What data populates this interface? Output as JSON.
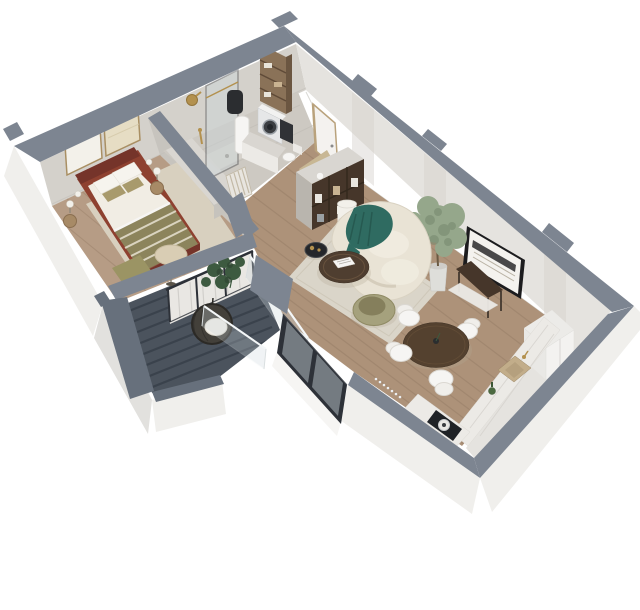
{
  "scene": {
    "type": "isometric-floor-plan-render",
    "description": "3D isometric cutaway render of a one-bedroom apartment viewed from above: bedroom top-left, bathroom top-center, entry hall, open living/dining room with curved cream sofa, kitchen bottom-right, and a balcony with dark decking bottom-left. Cut wall tops are slate gray, exterior faces white.",
    "background": "#ffffff"
  },
  "palette": {
    "wall_top": "#7d8591",
    "wall_top_dark": "#67707c",
    "outer_face": "#f0efec",
    "outer_face_shade": "#e2e1de",
    "inner_wall_light": "#e5e3df",
    "inner_wall_mid": "#d4d1cb",
    "inner_wall_dark": "#c7c4be",
    "floor_wood": "#ad9279",
    "floor_wood_bedroom": "#b69c85",
    "plank_line": "#8f7660",
    "bath_floor": "#cdc9c2",
    "rug_living": "#dad5c9",
    "rug_bedroom": "#d8d0bf",
    "balcony_floor": "#4b535d",
    "balcony_stripe": "#39414b",
    "glass": "#ccd7dc",
    "window_frame": "#2d3138",
    "door_white": "#f4f2ef",
    "door_frame": "#b9a27c",
    "doormat": "#c8b794",
    "bed_frame": "#8e4130",
    "bed_frame_dark": "#75342a",
    "duvet": "#f1ede4",
    "pillow_white": "#f6f4ee",
    "pillow_olive": "#a89a6c",
    "blanket_olive": "#8c845c",
    "blanket_cream": "#e8e2d2",
    "bench_olive": "#9b9464",
    "wood_furniture": "#54412f",
    "wood_furniture_dark": "#46362a",
    "wood_light": "#8a7258",
    "sofa_cream": "#e9e3d5",
    "sofa_shade": "#cfc7b5",
    "throw_teal": "#2f6b61",
    "throw_teal_dark": "#24554d",
    "armchair_olive": "#a5a17d",
    "armchair_olive_dark": "#857f5c",
    "tree_foliage": "#95a78b",
    "tree_foliage_dark": "#76886d",
    "monstera": "#3d5a40",
    "monstera_dark": "#2f4632",
    "pot_white": "#dededa",
    "lamp_shade": "#f2f0ea",
    "lamp_shade_beige": "#d9cdb4",
    "gold": "#b3914f",
    "near_black": "#24262a",
    "white": "#f6f5f3",
    "marble": "#eceae6",
    "marble_vein": "#d5d2cd",
    "sink_beige": "#c2ad8a",
    "sink_beige_dark": "#b5a07e",
    "appliance": "#e6e7e8",
    "appliance_dark": "#3a3d41",
    "cabinet_light": "#d9d6d1",
    "cabinet_mid": "#c6c3bd",
    "curtain": "#e9e7e3",
    "curtain_fold": "#cfcdc9",
    "rattan": "#43403a",
    "rattan_dark": "#2c2a26",
    "shadow": "#b5ac99"
  },
  "rooms": [
    {
      "id": "bedroom",
      "label": "Bedroom",
      "furniture": [
        "double-bed",
        "striped-throw-blanket",
        "two-framed-artworks",
        "nightstands",
        "wall-lamps",
        "floor-lamp",
        "bench",
        "area-rug",
        "wardrobe-cabinet"
      ]
    },
    {
      "id": "bathroom",
      "label": "Bathroom",
      "furniture": [
        "walk-in-shower",
        "gold-shower-head",
        "glass-partition",
        "water-heater",
        "washing-machine",
        "storage-column",
        "bathroom-cabinet",
        "toilet",
        "towel-radiator"
      ]
    },
    {
      "id": "entry-hall",
      "label": "Entry hall",
      "furniture": [
        "entry-door",
        "doormat",
        "wall-mirror"
      ]
    },
    {
      "id": "living-room",
      "label": "Living room",
      "furniture": [
        "curved-sofa",
        "teal-throw",
        "round-coffee-table",
        "open-shelf-unit",
        "floor-lamp",
        "wire-side-table",
        "olive-armchair",
        "area-rug",
        "potted-olive-tree",
        "console-table",
        "framed-wall-art"
      ]
    },
    {
      "id": "dining-area",
      "label": "Dining area",
      "furniture": [
        "round-dining-table",
        "dining-chairs-x4"
      ]
    },
    {
      "id": "kitchen",
      "label": "Kitchen",
      "furniture": [
        "marble-counter",
        "inset-sink",
        "induction-cooktop",
        "tall-fridge-cabinet",
        "green-bottle"
      ]
    },
    {
      "id": "balcony",
      "label": "Balcony",
      "furniture": [
        "hanging-rattan-chair",
        "monstera-plants",
        "glass-railing",
        "sheer-curtain",
        "ribbed-decking"
      ]
    }
  ]
}
